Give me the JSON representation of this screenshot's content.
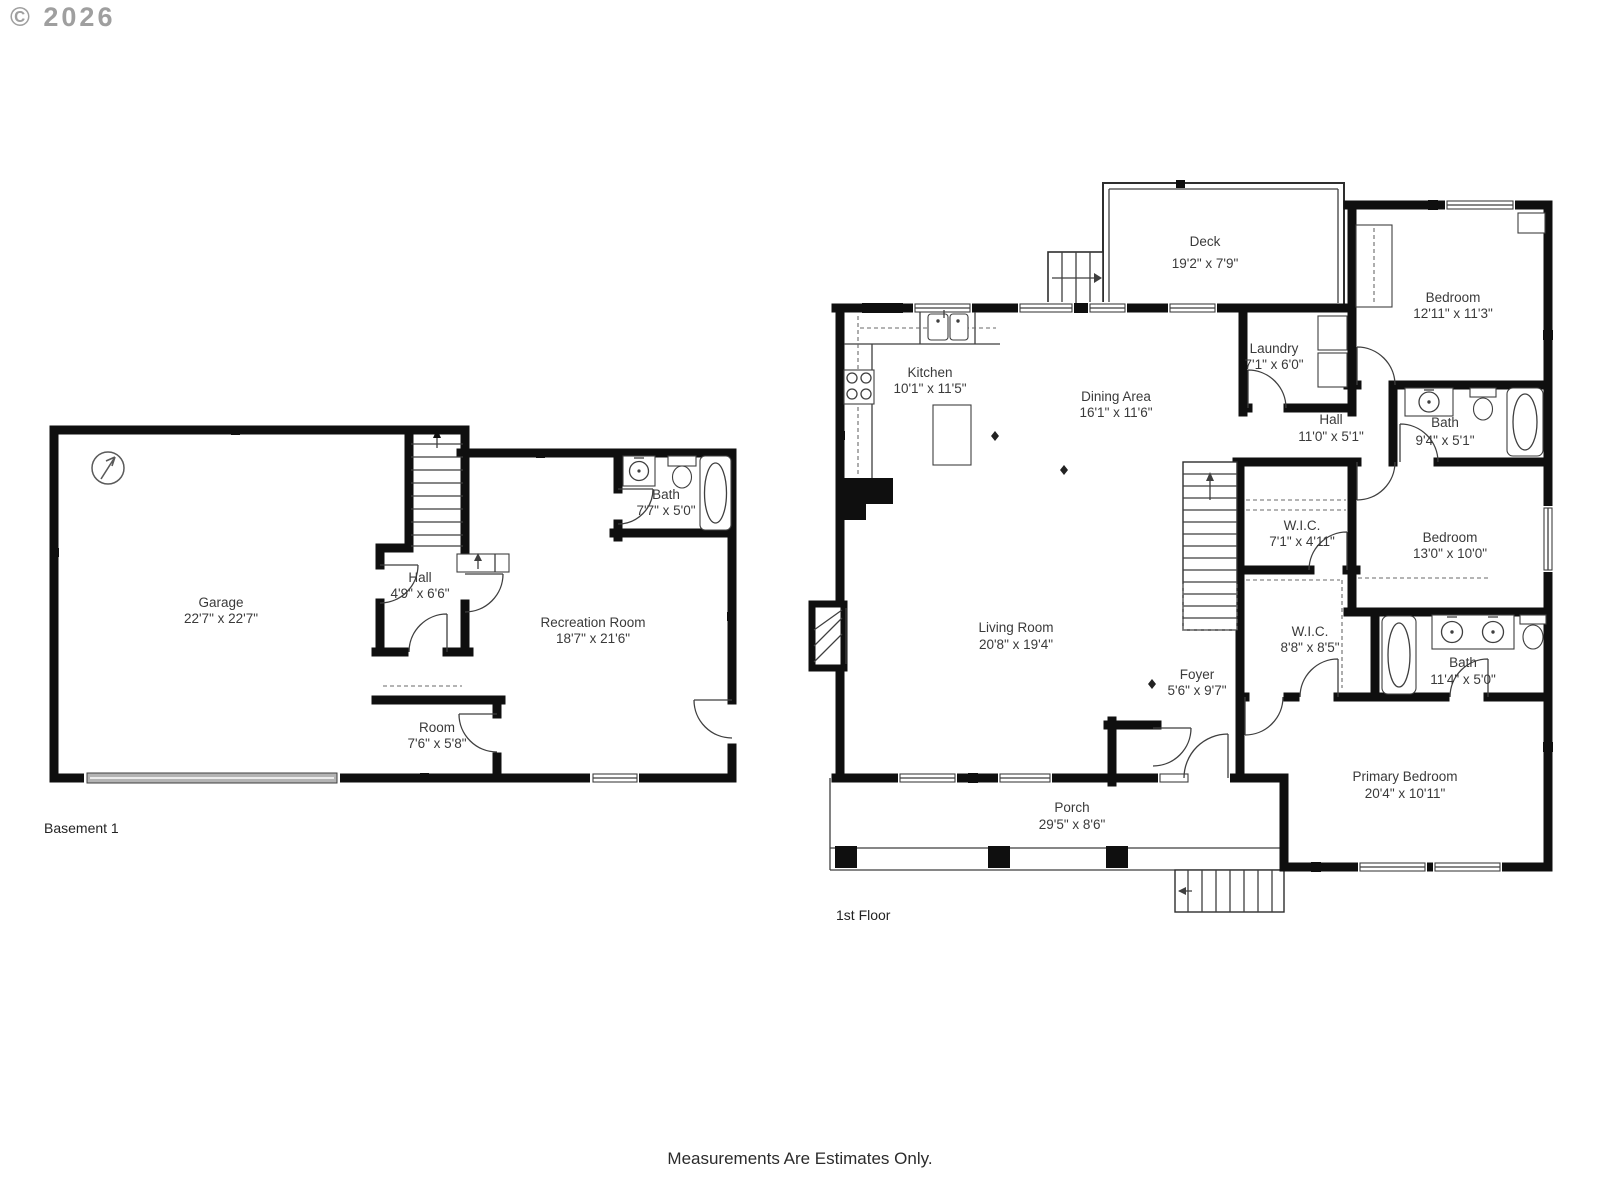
{
  "watermark": {
    "copyright": "© 2026"
  },
  "footer": {
    "disclaimer": "Measurements Are Estimates Only."
  },
  "plans": [
    {
      "caption": "Basement 1",
      "rooms": {
        "garage": {
          "label": "Garage",
          "dims": "22'7\" x 22'7\""
        },
        "hall": {
          "label": "Hall",
          "dims": "4'9\" x 6'6\""
        },
        "bath": {
          "label": "Bath",
          "dims": "7'7\" x 5'0\""
        },
        "recreation": {
          "label": "Recreation Room",
          "dims": "18'7\" x 21'6\""
        },
        "room": {
          "label": "Room",
          "dims": "7'6\" x 5'8\""
        }
      }
    },
    {
      "caption": "1st Floor",
      "rooms": {
        "deck": {
          "label": "Deck",
          "dims": "19'2\" x 7'9\""
        },
        "kitchen": {
          "label": "Kitchen",
          "dims": "10'1\" x 11'5\""
        },
        "dining": {
          "label": "Dining Area",
          "dims": "16'1\" x 11'6\""
        },
        "laundry": {
          "label": "Laundry",
          "dims": "7'1\" x 6'0\""
        },
        "bedroom1": {
          "label": "Bedroom",
          "dims": "12'11\" x 11'3\""
        },
        "hall": {
          "label": "Hall",
          "dims": "11'0\" x 5'1\""
        },
        "bath1": {
          "label": "Bath",
          "dims": "9'4\" x 5'1\""
        },
        "wic1": {
          "label": "W.I.C.",
          "dims": "7'1\" x 4'11\""
        },
        "bedroom2": {
          "label": "Bedroom",
          "dims": "13'0\" x 10'0\""
        },
        "living": {
          "label": "Living Room",
          "dims": "20'8\" x 19'4\""
        },
        "foyer": {
          "label": "Foyer",
          "dims": "5'6\" x 9'7\""
        },
        "wic2": {
          "label": "W.I.C.",
          "dims": "8'8\" x 8'5\""
        },
        "bath2": {
          "label": "Bath",
          "dims": "11'4\" x 5'0\""
        },
        "primary": {
          "label": "Primary Bedroom",
          "dims": "20'4\" x 10'11\""
        },
        "porch": {
          "label": "Porch",
          "dims": "29'5\" x 8'6\""
        }
      }
    }
  ],
  "colors": {
    "wall": "#0f0f0f",
    "line": "#3f3f3f",
    "text": "#3a3a3a",
    "garage_door": "#b3b3b3"
  }
}
